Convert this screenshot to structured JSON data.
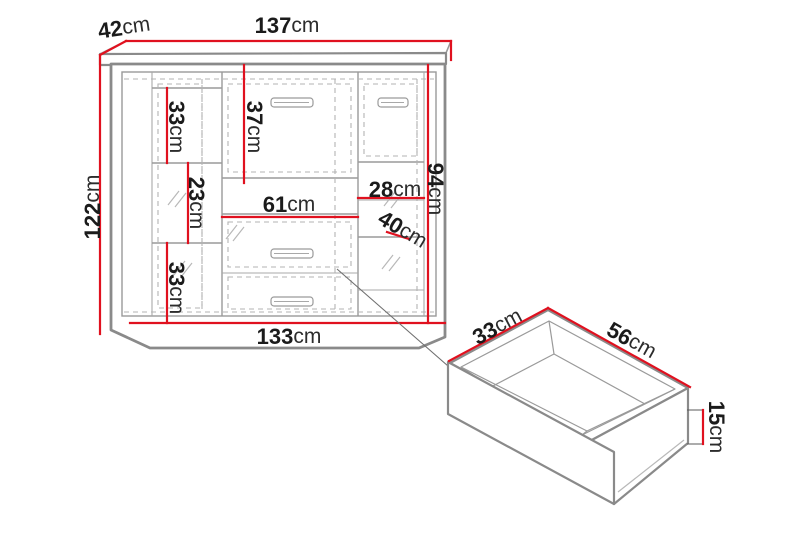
{
  "colors": {
    "dimension_red": "#e0111f",
    "structure_gray": "#8a8a8a",
    "dashed_gray": "#b3b3b3",
    "label_text": "#1b1b1b"
  },
  "cabinet": {
    "top_width": {
      "value": "137",
      "unit": "cm"
    },
    "top_depth": {
      "value": "42",
      "unit": "cm"
    },
    "total_height": {
      "value": "122",
      "unit": "cm"
    },
    "left_top_compartment": {
      "value": "33",
      "unit": "cm"
    },
    "left_middle_compartment": {
      "value": "23",
      "unit": "cm"
    },
    "left_bottom_compartment": {
      "value": "33",
      "unit": "cm"
    },
    "center_door_height": {
      "value": "37",
      "unit": "cm"
    },
    "center_width": {
      "value": "61",
      "unit": "cm"
    },
    "right_compartment_width": {
      "value": "28",
      "unit": "cm"
    },
    "right_compartment_depth": {
      "value": "40",
      "unit": "cm"
    },
    "right_interior_height": {
      "value": "94",
      "unit": "cm"
    },
    "base_width": {
      "value": "133",
      "unit": "cm"
    }
  },
  "drawer_detail": {
    "depth": {
      "value": "33",
      "unit": "cm"
    },
    "width": {
      "value": "56",
      "unit": "cm"
    },
    "height": {
      "value": "15",
      "unit": "cm"
    }
  }
}
